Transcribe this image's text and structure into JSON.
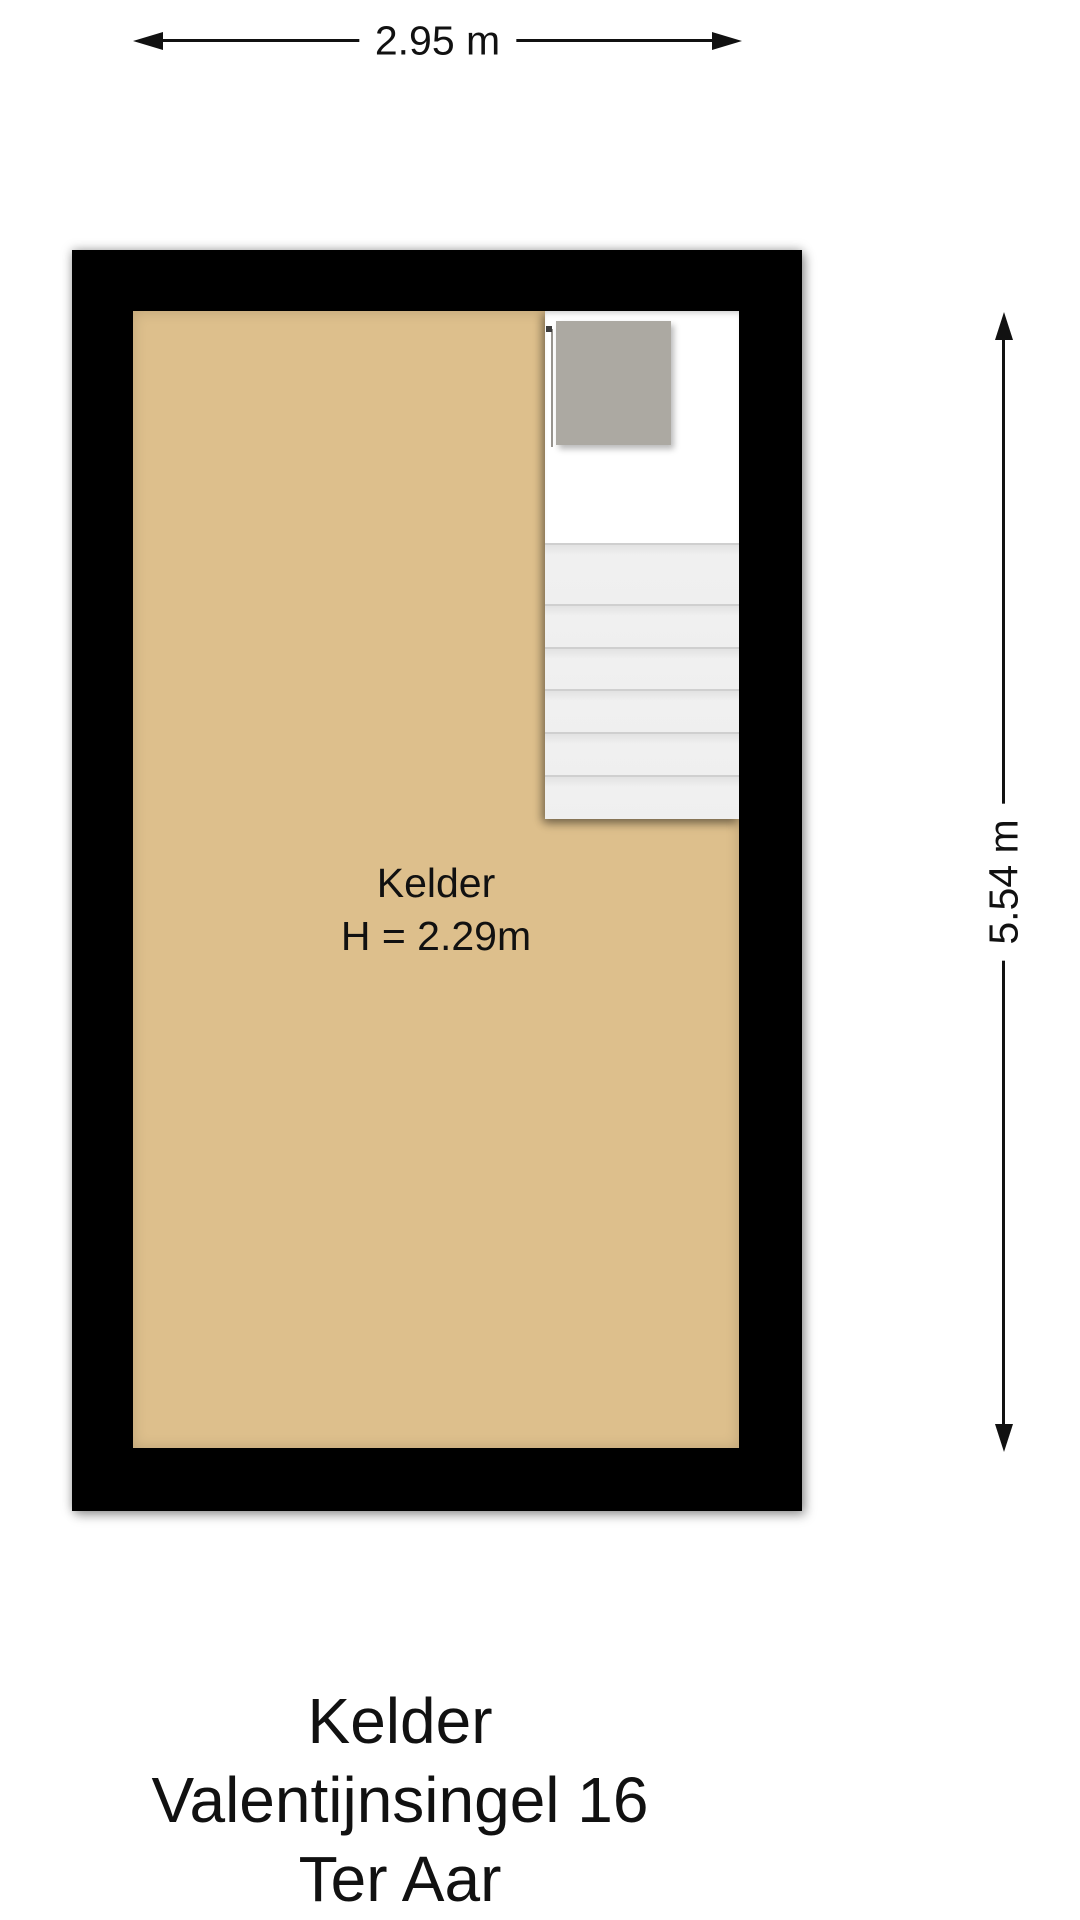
{
  "plan": {
    "room_label": "Kelder",
    "ceiling_height_label": "H = 2.29m",
    "width_dimension_label": "2.95 m",
    "height_dimension_label": "5.54 m"
  },
  "footer": {
    "lines": [
      "Kelder",
      "Valentijnsingel 16",
      "Ter Aar"
    ]
  },
  "stairs": {
    "tread_heights_px": [
      61,
      43,
      42,
      43,
      43,
      44
    ]
  },
  "colors": {
    "wall": "#000000",
    "floor": "#ddbf8c",
    "landing": "#aca9a2",
    "stairwell": "#ffffff",
    "tread": "#efefef",
    "tread-edge": "#cfcfcf",
    "text": "#111111"
  }
}
